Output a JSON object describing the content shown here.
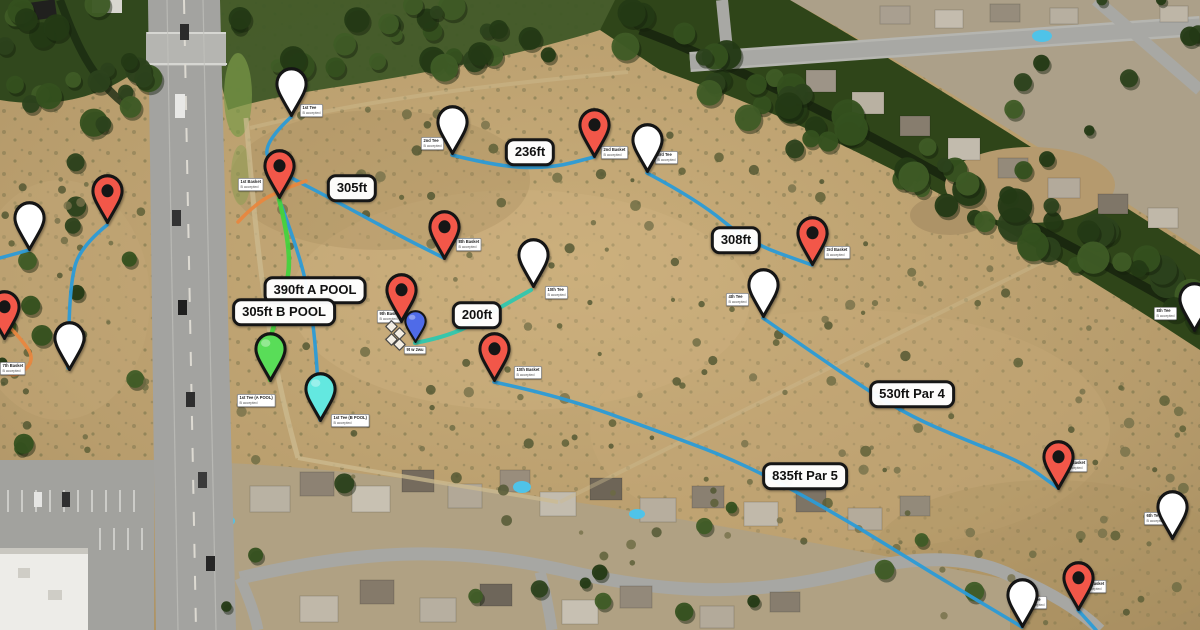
{
  "map": {
    "description": "Satellite disc-golf course map with hole pins and distance labels",
    "colors": {
      "line_blue": "#2b9bd7",
      "line_green": "#45d33d",
      "line_teal": "#2fc7ae",
      "line_orange": "#e8873f",
      "pin_red": "#f25749",
      "pin_white": "#ffffff",
      "pin_green": "#59dd58",
      "pin_cyan": "#63e8e0",
      "pin_blue": "#4f6be8"
    },
    "distance_labels": [
      {
        "text": "305ft",
        "x": 352,
        "y": 188
      },
      {
        "text": "236ft",
        "x": 530,
        "y": 152
      },
      {
        "text": "308ft",
        "x": 736,
        "y": 240
      },
      {
        "text": "390ft A POOL",
        "x": 315,
        "y": 290
      },
      {
        "text": "305ft B POOL",
        "x": 284,
        "y": 312
      },
      {
        "text": "200ft",
        "x": 477,
        "y": 315
      },
      {
        "text": "530ft Par 4",
        "x": 912,
        "y": 394
      },
      {
        "text": "835ft Par 5",
        "x": 805,
        "y": 476
      }
    ],
    "markers": [
      {
        "color": "white",
        "x": 291,
        "y": 117,
        "note": {
          "x": 300,
          "y": 104,
          "lines": [
            "1st Tee",
            "B accepted"
          ]
        }
      },
      {
        "color": "red",
        "x": 279,
        "y": 199,
        "note": {
          "x": 238,
          "y": 178,
          "lines": [
            "1st Basket",
            "B accepted"
          ]
        }
      },
      {
        "color": "white",
        "x": 452,
        "y": 155,
        "note": {
          "x": 421,
          "y": 137,
          "lines": [
            "2nd Tee",
            "B accepted"
          ]
        }
      },
      {
        "color": "red",
        "x": 594,
        "y": 158,
        "note": {
          "x": 601,
          "y": 146,
          "lines": [
            "2nd Basket",
            "B accepted"
          ]
        }
      },
      {
        "color": "white",
        "x": 647,
        "y": 173,
        "note": {
          "x": 655,
          "y": 151,
          "lines": [
            "3rd Tee",
            "B accepted"
          ]
        }
      },
      {
        "color": "red",
        "x": 812,
        "y": 266,
        "note": {
          "x": 824,
          "y": 246,
          "lines": [
            "3rd Basket",
            "B accepted"
          ]
        }
      },
      {
        "color": "white",
        "x": 763,
        "y": 318,
        "note": {
          "x": 726,
          "y": 293,
          "lines": [
            "4th Tee",
            "B accepted"
          ]
        }
      },
      {
        "color": "red",
        "x": 1058,
        "y": 490,
        "note": {
          "x": 1062,
          "y": 459,
          "lines": [
            "4th Basket",
            "B accepted"
          ]
        }
      },
      {
        "color": "white",
        "x": 1172,
        "y": 540,
        "note": {
          "x": 1144,
          "y": 512,
          "lines": [
            "6th Tee",
            "B accepted"
          ]
        }
      },
      {
        "color": "white",
        "x": 1022,
        "y": 628,
        "note": {
          "x": 1024,
          "y": 596,
          "lines": [
            "5th Tee",
            "B accepted"
          ]
        }
      },
      {
        "color": "red",
        "x": 1078,
        "y": 611,
        "note": {
          "x": 1081,
          "y": 580,
          "lines": [
            "5th Basket",
            "B accepted"
          ]
        }
      },
      {
        "color": "red",
        "x": 444,
        "y": 260,
        "note": {
          "x": 456,
          "y": 238,
          "lines": [
            "8th Basket",
            "B accepted"
          ]
        }
      },
      {
        "color": "white",
        "x": 533,
        "y": 288,
        "note": {
          "x": 545,
          "y": 286,
          "lines": [
            "10th Tee",
            "B accepted"
          ]
        }
      },
      {
        "color": "red",
        "x": 401,
        "y": 323,
        "note": {
          "x": 377,
          "y": 310,
          "lines": [
            "9th Basket",
            "B accepted"
          ]
        }
      },
      {
        "color": "blue",
        "x": 415,
        "y": 343,
        "note": {
          "x": 404,
          "y": 346,
          "lines": [
            "9t w 2wu"
          ]
        }
      },
      {
        "color": "red",
        "x": 494,
        "y": 382,
        "note": {
          "x": 514,
          "y": 366,
          "lines": [
            "10th Basket",
            "B accepted"
          ]
        }
      },
      {
        "color": "green",
        "x": 270,
        "y": 382,
        "note": {
          "x": 237,
          "y": 394,
          "lines": [
            "1st Tee (A POOL)",
            "B accepted"
          ]
        }
      },
      {
        "color": "cyan",
        "x": 320,
        "y": 422,
        "note": {
          "x": 331,
          "y": 414,
          "lines": [
            "1st Tee (B POOL)",
            "B accepted"
          ]
        }
      },
      {
        "color": "white",
        "x": 29,
        "y": 251
      },
      {
        "color": "red",
        "x": 107,
        "y": 224
      },
      {
        "color": "red",
        "x": 4,
        "y": 340,
        "note": {
          "x": 0,
          "y": 362,
          "lines": [
            "7th Basket",
            "B accepted"
          ]
        }
      },
      {
        "color": "white",
        "x": 69,
        "y": 371
      },
      {
        "color": "white",
        "x": 1194,
        "y": 332,
        "note": {
          "x": 1154,
          "y": 307,
          "lines": [
            "8th Tee",
            "B accepted"
          ]
        }
      }
    ],
    "diamonds": [
      [
        390,
        325
      ],
      [
        398,
        332
      ],
      [
        390,
        338
      ],
      [
        398,
        343
      ]
    ],
    "paths": [
      {
        "color": "#2b9bd7",
        "w": 3.5,
        "pts": [
          [
            291,
            117
          ],
          [
            263,
            143
          ],
          [
            272,
            168
          ],
          [
            330,
            198
          ],
          [
            400,
            236
          ],
          [
            444,
            258
          ]
        ]
      },
      {
        "color": "#2b9bd7",
        "w": 3.5,
        "pts": [
          [
            452,
            155
          ],
          [
            500,
            167
          ],
          [
            552,
            168
          ],
          [
            594,
            157
          ]
        ]
      },
      {
        "color": "#2b9bd7",
        "w": 3.5,
        "pts": [
          [
            647,
            173
          ],
          [
            698,
            200
          ],
          [
            748,
            242
          ],
          [
            812,
            265
          ]
        ]
      },
      {
        "color": "#2b9bd7",
        "w": 3.5,
        "pts": [
          [
            763,
            318
          ],
          [
            840,
            372
          ],
          [
            905,
            414
          ],
          [
            968,
            441
          ],
          [
            1022,
            462
          ],
          [
            1058,
            488
          ]
        ]
      },
      {
        "color": "#2b9bd7",
        "w": 3.5,
        "pts": [
          [
            494,
            382
          ],
          [
            560,
            396
          ],
          [
            660,
            432
          ],
          [
            745,
            464
          ],
          [
            840,
            516
          ],
          [
            930,
            572
          ],
          [
            1022,
            627
          ]
        ]
      },
      {
        "color": "#2b9bd7",
        "w": 3.5,
        "pts": [
          [
            1078,
            610
          ],
          [
            1096,
            630
          ]
        ]
      },
      {
        "color": "#2b9bd7",
        "w": 3.5,
        "pts": [
          [
            279,
            199
          ],
          [
            298,
            250
          ],
          [
            310,
            300
          ],
          [
            316,
            350
          ],
          [
            320,
            420
          ]
        ]
      },
      {
        "color": "#2b9bd7",
        "w": 3.5,
        "pts": [
          [
            107,
            225
          ],
          [
            80,
            247
          ],
          [
            70,
            285
          ],
          [
            68,
            368
          ]
        ]
      },
      {
        "color": "#2b9bd7",
        "w": 3.5,
        "pts": [
          [
            0,
            258
          ],
          [
            29,
            250
          ]
        ]
      },
      {
        "color": "#45d33d",
        "w": 4.5,
        "pts": [
          [
            279,
            199
          ],
          [
            292,
            250
          ],
          [
            284,
            300
          ],
          [
            268,
            340
          ],
          [
            270,
            380
          ]
        ]
      },
      {
        "color": "#2fc7ae",
        "w": 4,
        "pts": [
          [
            415,
            343
          ],
          [
            452,
            336
          ],
          [
            492,
            312
          ],
          [
            531,
            290
          ]
        ]
      },
      {
        "color": "#e8873f",
        "w": 3.5,
        "pts": [
          [
            238,
            222
          ],
          [
            256,
            203
          ],
          [
            284,
            189
          ],
          [
            306,
            181
          ]
        ]
      },
      {
        "color": "#e8873f",
        "w": 3.5,
        "pts": [
          [
            5,
            322
          ],
          [
            28,
            346
          ],
          [
            33,
            362
          ],
          [
            18,
            376
          ],
          [
            5,
            373
          ]
        ]
      }
    ]
  }
}
